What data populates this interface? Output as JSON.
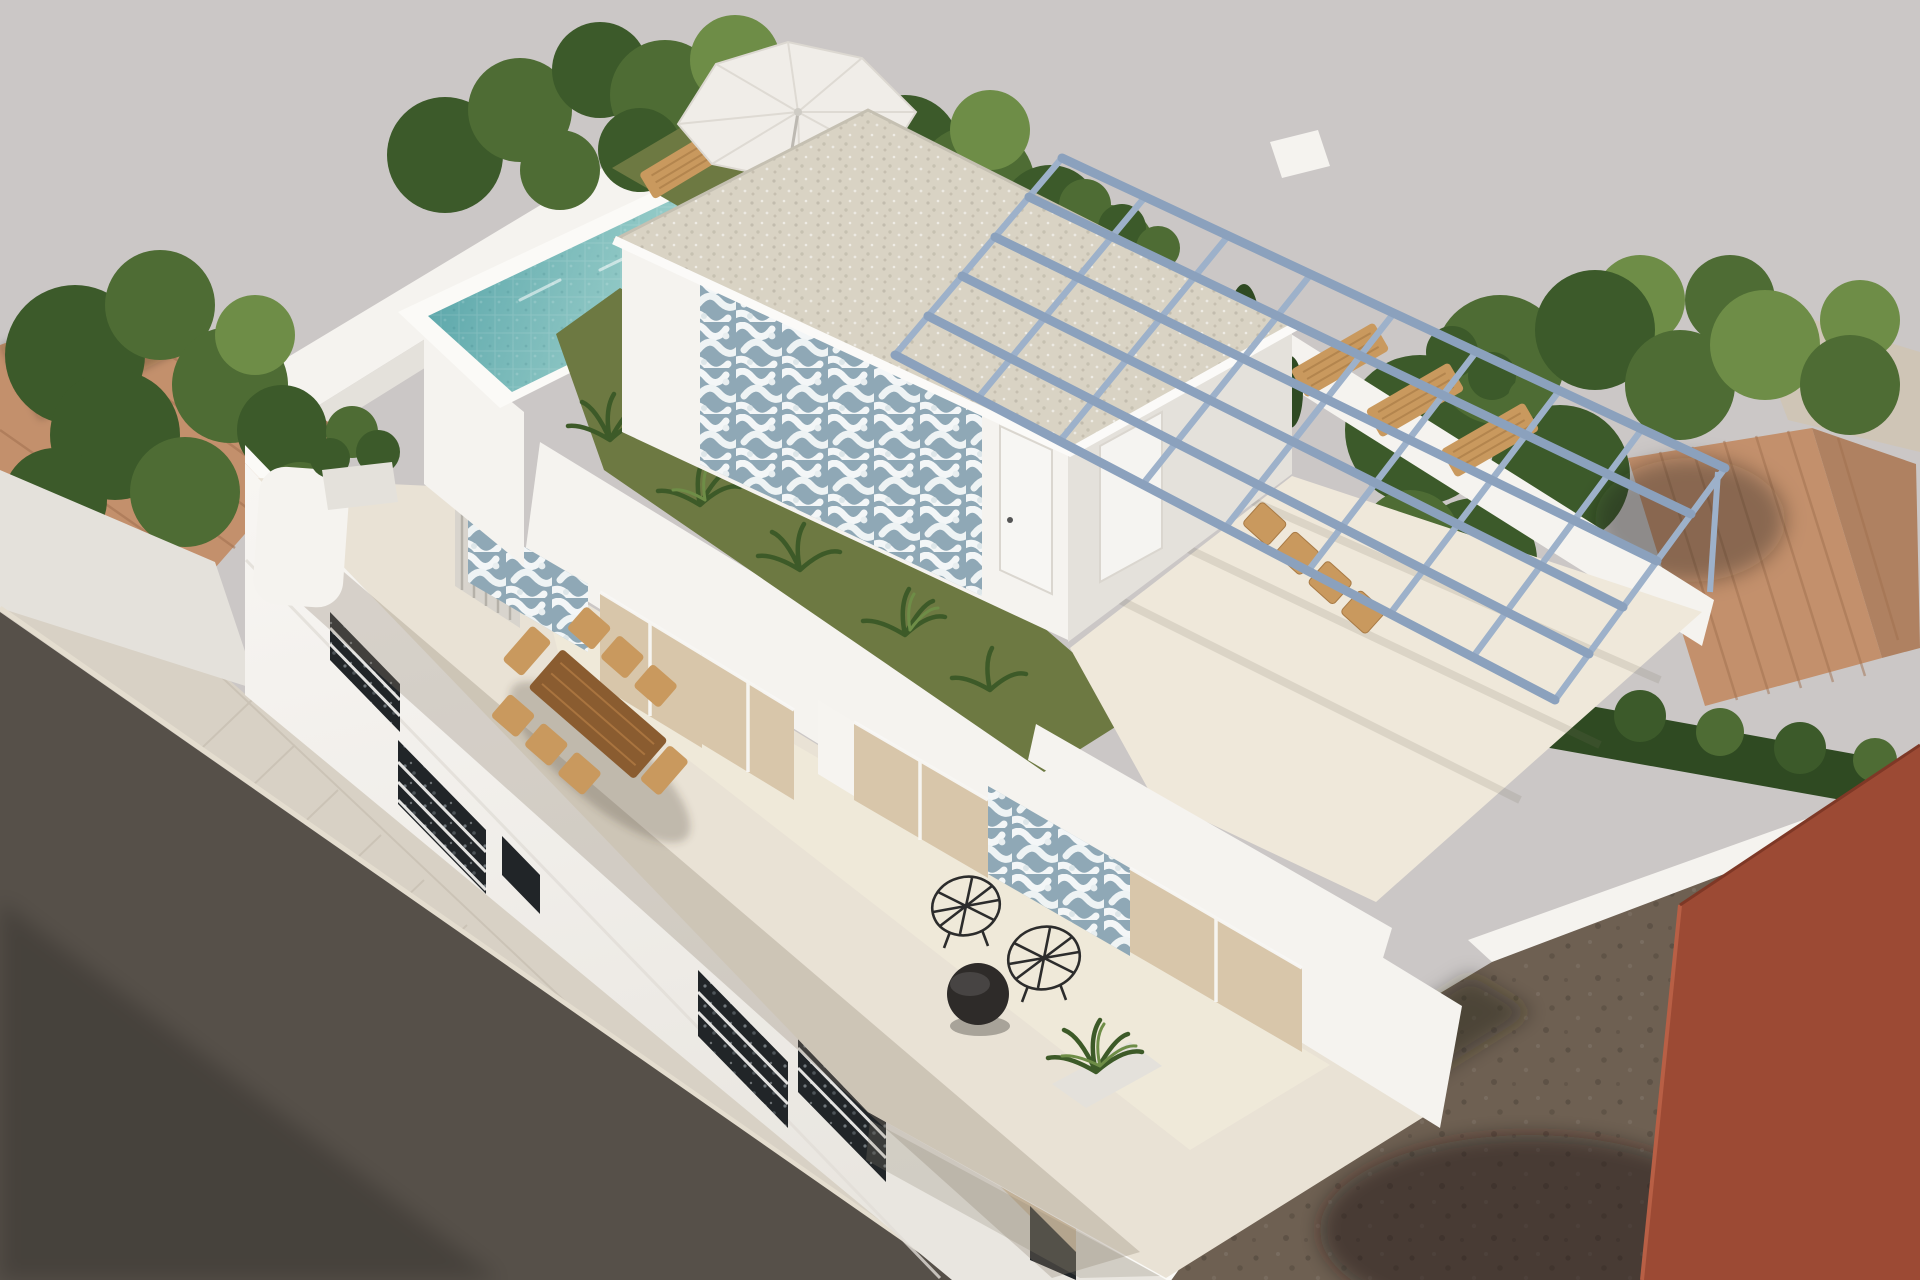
{
  "palette": {
    "background": "#cbc7c6",
    "wall_white": "#f5f3ef",
    "wall_shade": "#e4e1db",
    "wall_bright": "#fbfaf7",
    "terrace_floor": "#e9e2d5",
    "floor_sun": "#f3ecdc",
    "floor_shadow": "#8d8271",
    "sidewalk": "#d8d1c5",
    "asphalt": "#565049",
    "dirt": "#6e6052",
    "red_building": "#9c4a34",
    "terracotta": "#c3906c",
    "terracotta_line": "#a1714f",
    "pale_roof": "#cfc5b6",
    "lawn": "#6d7942",
    "plant_dark": "#3d5a28",
    "tree_dark": "#3c5a2a",
    "tree_mid": "#4e6c34",
    "tree_light": "#6e8d47",
    "hedge": "#2f4a22",
    "pool_deep": "#5ea9ab",
    "pool_water": "#85c2bf",
    "pool_steps": "#bfe3dc",
    "roof_gravel": "#d9d3c4",
    "azulejo": "#8fa8b6",
    "azulejo_white": "#f3f6f7",
    "glass_tan": "#d8c6aa",
    "dark_window": "#212528",
    "curtain": "#f6f4f0",
    "parasol": "#f0ede8",
    "pergola": "#8ba1bd",
    "pergola_light": "#9db1ca",
    "wood": "#c9995e",
    "wood_dark": "#8a5c30",
    "black_furniture": "#2e2b29",
    "railing": "#f8f7f4"
  },
  "scene_objects": [
    "white modern villa (aerial 3d render)",
    "rooftop swimming pool with mosaic water",
    "white sun parasol with wooden loungers",
    "penthouse roof room with gravel flat roof",
    "blue-white azulejo patterned tile panels",
    "steel blue pergola grid over roof terrace",
    "rooftop dining table with chairs",
    "wooden dining table on upper terrace",
    "black wire chairs and round black table",
    "artificial lawn strips with tropical plants",
    "neighbouring terracotta tiled roofs",
    "green trees and hedges",
    "tiled sidewalk and asphalt street",
    "vacant dirt lot",
    "red brick building corner"
  ]
}
